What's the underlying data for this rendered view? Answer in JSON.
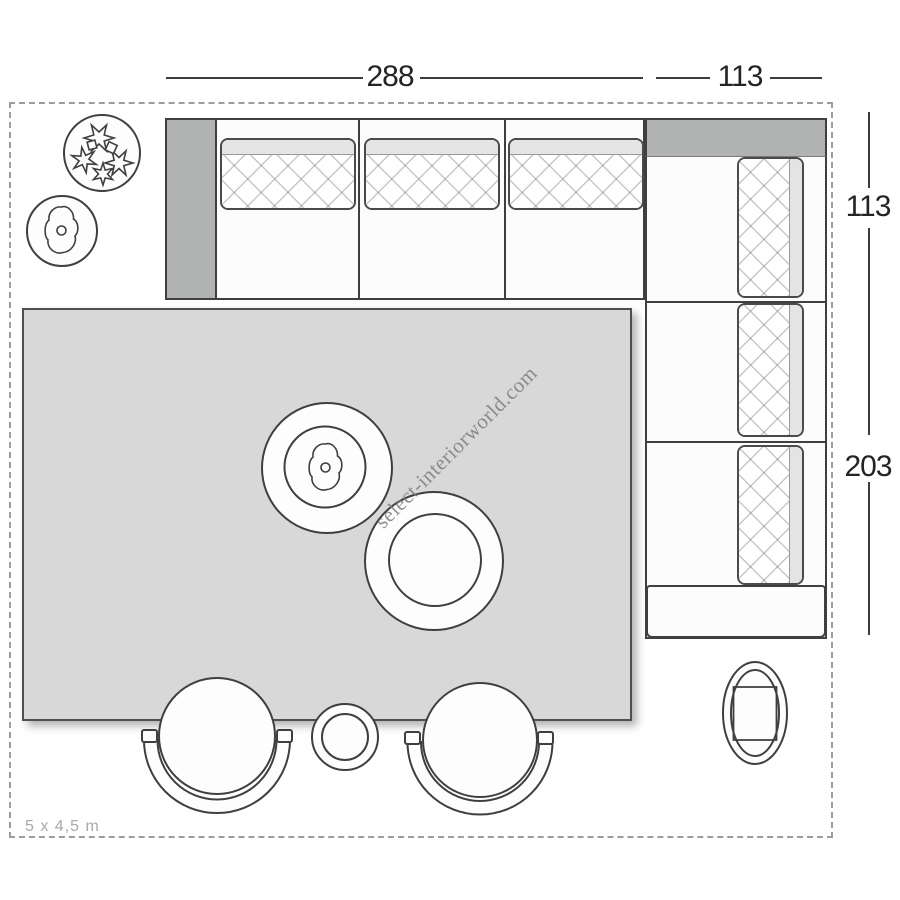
{
  "dimensions": {
    "top_sofa_width": "288",
    "top_corner_width": "113",
    "right_corner_depth": "113",
    "right_side_length": "203"
  },
  "room": {
    "size_label": "5 x 4,5 m"
  },
  "watermark": {
    "text": "select-interiorworld.com"
  },
  "colors": {
    "background": "#ffffff",
    "rug_gray": "#d8d8d8",
    "sofa_arm_gray": "#b1b3b2",
    "cushion_fold_gray": "#e4e4e4",
    "outline_dark": "#3f3f3f",
    "dashed_border_gray": "#9c9c9c",
    "dimension_text": "#242424",
    "room_label_text": "#a9a9a9",
    "watermark_text": "#7d7d7d"
  }
}
